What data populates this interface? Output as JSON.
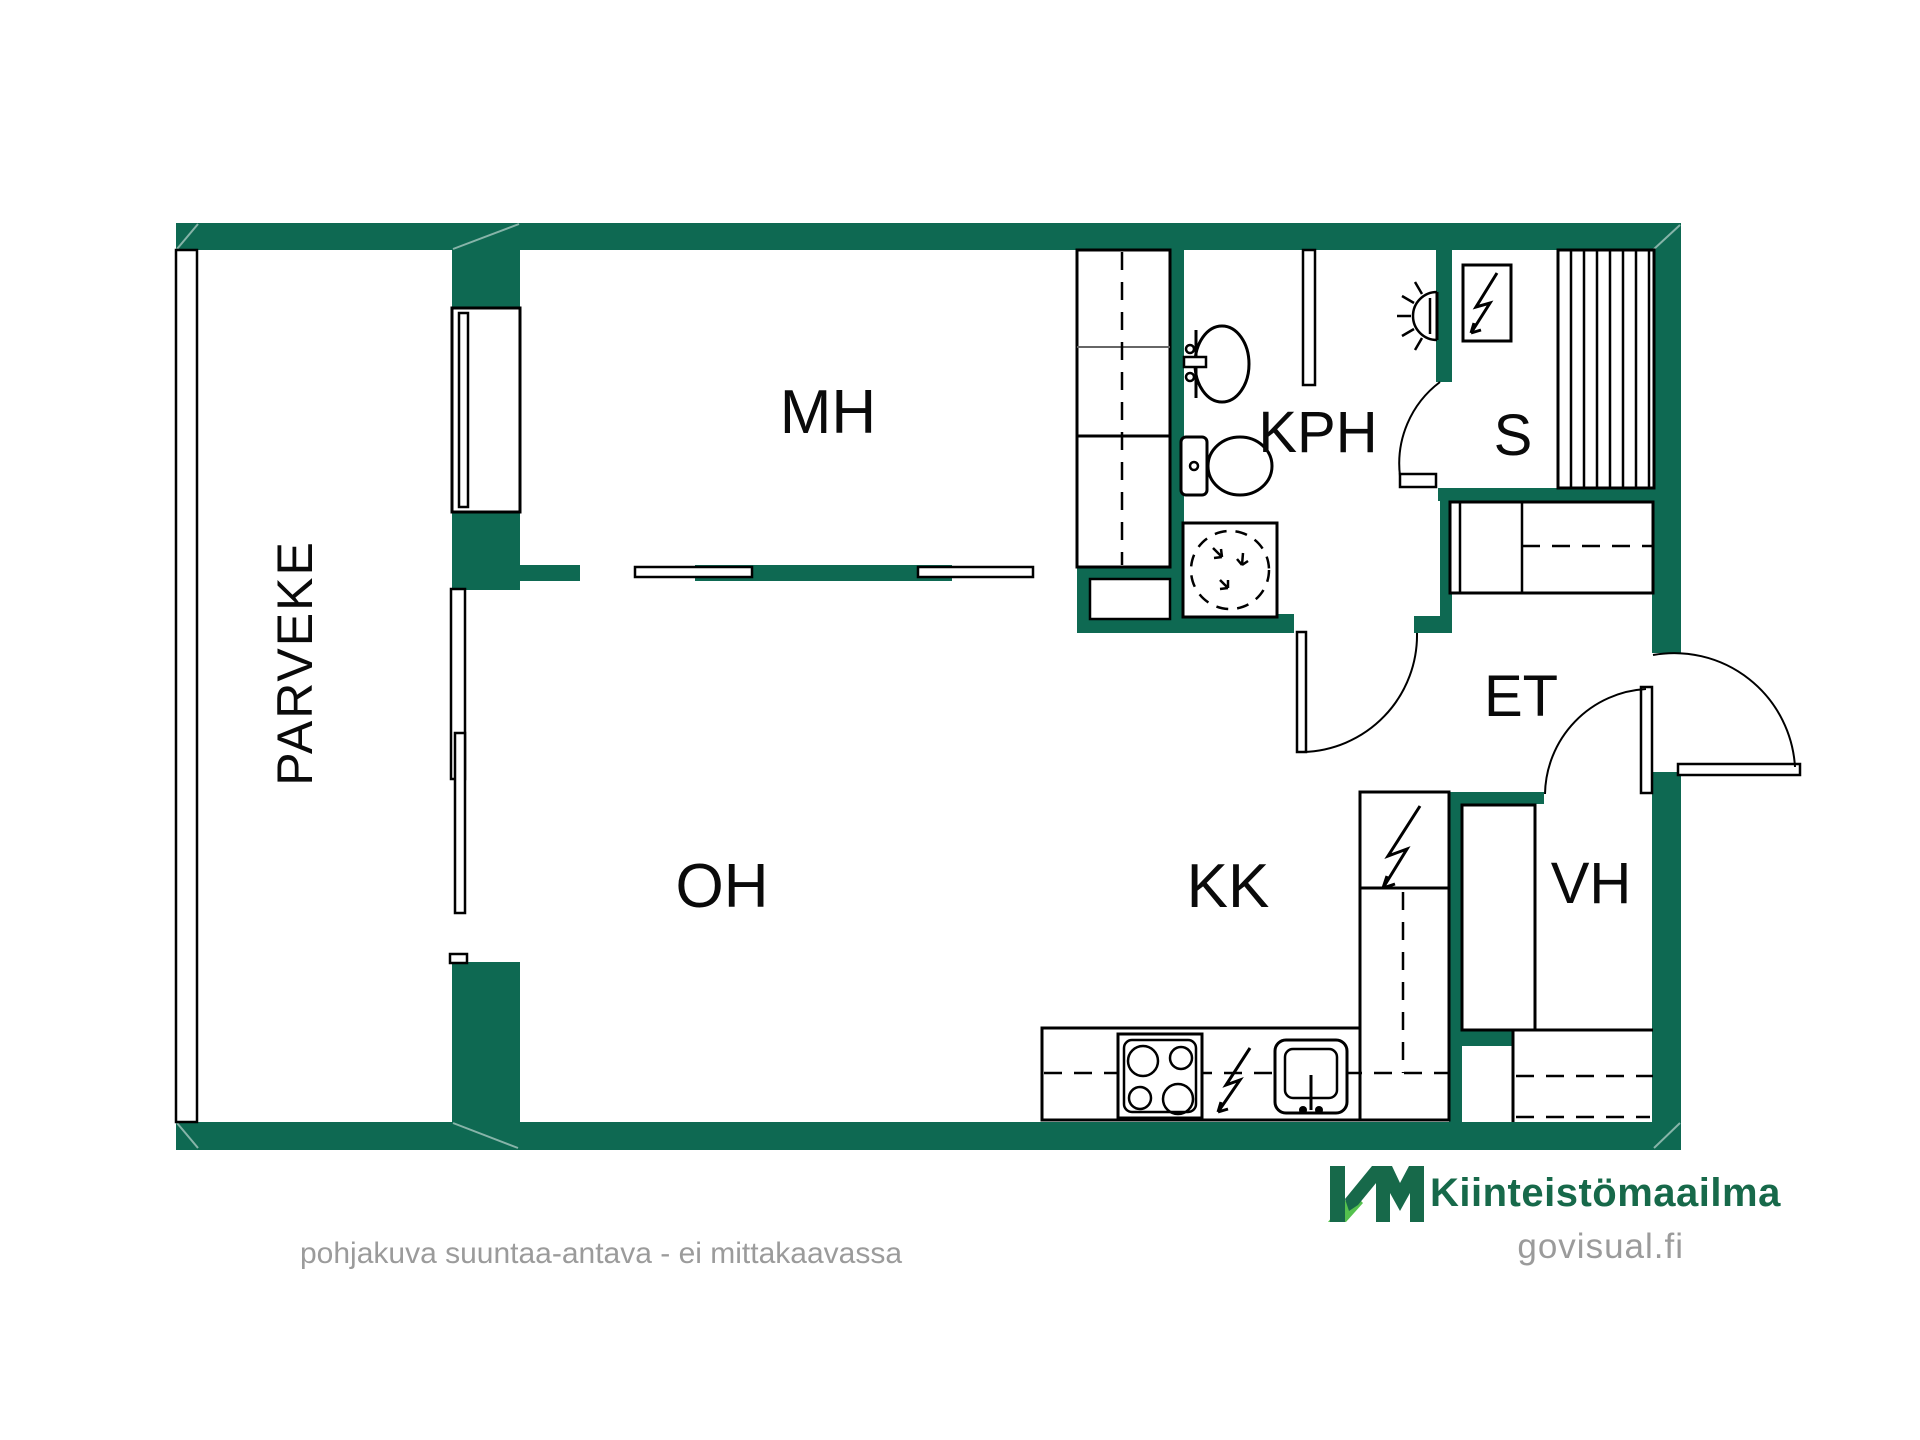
{
  "plan": {
    "rooms": {
      "parveke": "PARVEKE",
      "mh": "MH",
      "kph": "KPH",
      "s": "S",
      "et": "ET",
      "oh": "OH",
      "kk": "KK",
      "vh": "VH"
    }
  },
  "branding": {
    "logo_initials": "KM",
    "logo_text": "Kiinteistömaailma",
    "website": "govisual.fi"
  },
  "footer": {
    "caption": "pohjakuva suuntaa-antava - ei mittakaavassa"
  },
  "colors": {
    "wall_green": "#0e6952",
    "logo_dark_green": "#17694a",
    "logo_light_green": "#55c14e",
    "muted_text": "#9b9b9b",
    "line_black": "#000000"
  },
  "icons": {
    "sauna_stove": "lightning-bolt-icon",
    "kitchen_tall_unit": "lightning-bolt-icon",
    "counter_appliance": "lightning-bolt-icon",
    "bathroom_wall_lamp": "wall-light-icon",
    "washing_machine": "dashed-drum-icon"
  }
}
